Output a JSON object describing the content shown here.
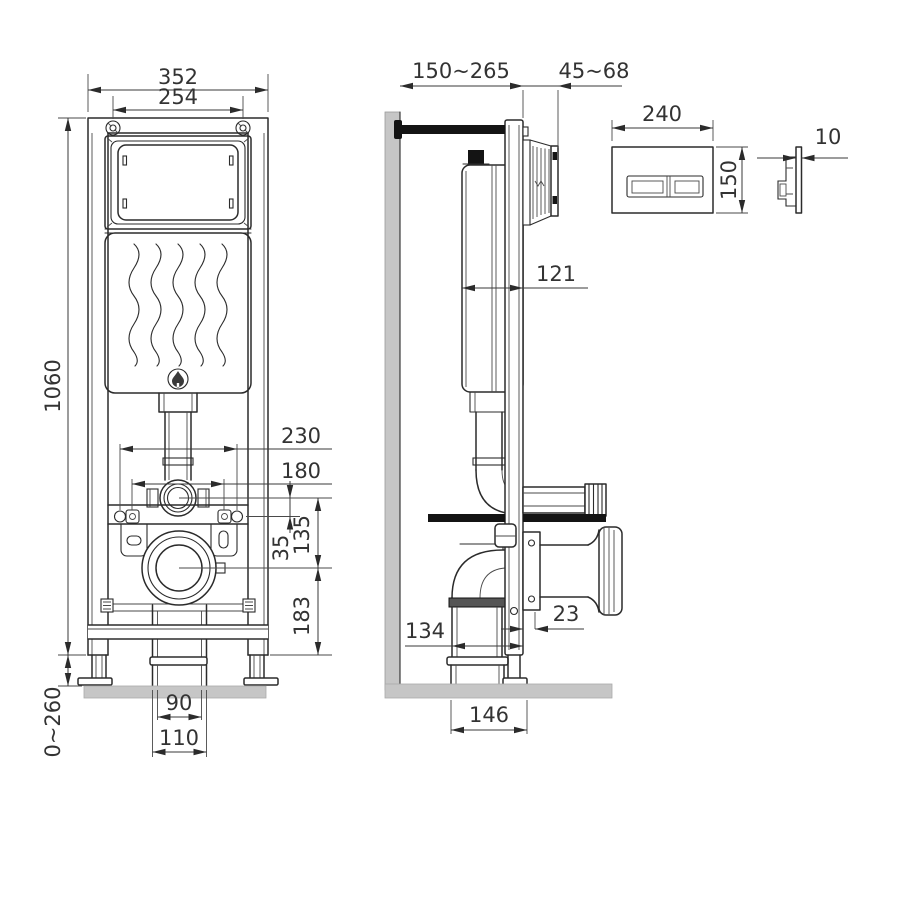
{
  "title": "concealed wc installation frame technical drawing",
  "colors": {
    "background": "#ffffff",
    "line": "#2b2b2b",
    "dim_text": "#333333",
    "wall": "#c6c6c6",
    "floor": "#c6c6c6",
    "black_part": "#141414",
    "coupling": "#9a9a9a",
    "coupling_dark": "#555555"
  },
  "front_view": {
    "name": "installation frame front view",
    "dims": {
      "frame_width": "352",
      "screw_spacing": "254",
      "frame_height": "1060",
      "leg_adjust_range": "0~260",
      "fixing_outer": "230",
      "fixing_inner": "180",
      "flush_to_fixing": "35",
      "flush_to_outlet": "135",
      "outlet_to_bottom": "183",
      "outlet_pipe_inner": "90",
      "outlet_pipe_outer": "110"
    }
  },
  "side_view": {
    "name": "installation frame side view",
    "dims": {
      "depth_range": "150~265",
      "shaft_range": "45~68",
      "cistern_depth": "121",
      "plate_offset": "23",
      "outlet_to_frame": "134",
      "base_depth": "146"
    }
  },
  "flush_plate": {
    "name": "flush plate",
    "dims": {
      "width": "240",
      "height": "150",
      "thickness": "10"
    }
  }
}
